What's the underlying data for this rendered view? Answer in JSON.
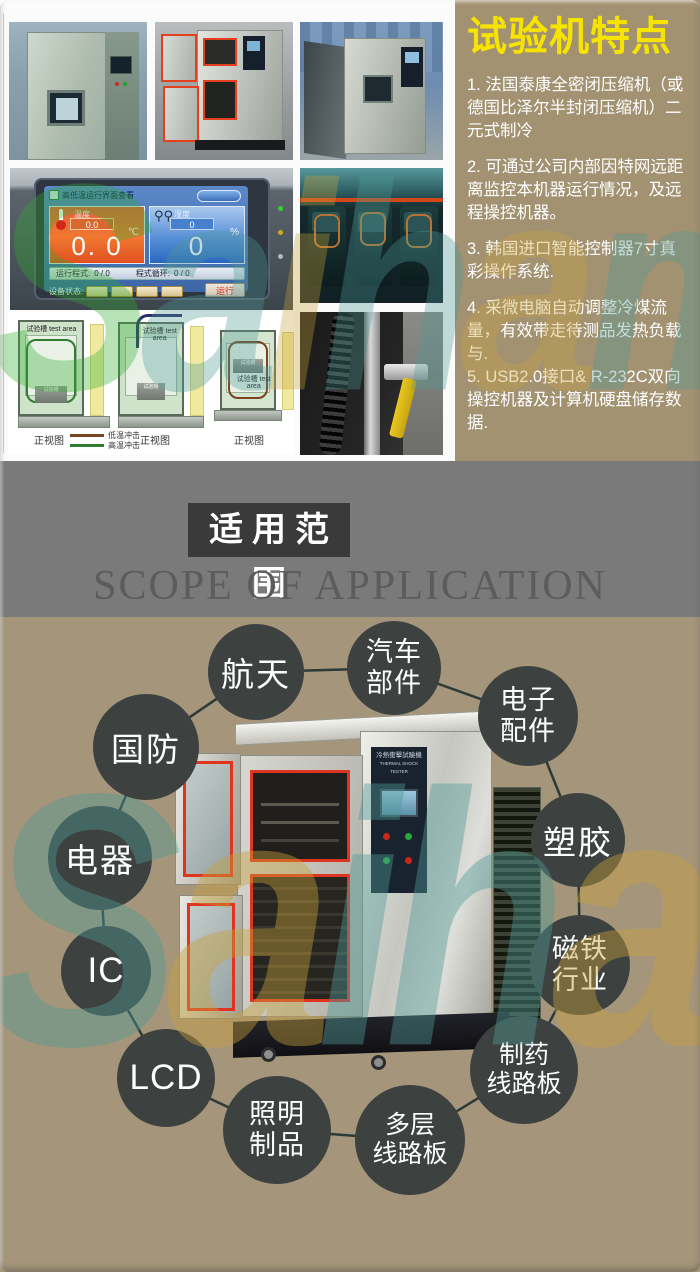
{
  "features": {
    "title": "试验机特点",
    "items": [
      "1. 法国泰康全密闭压缩机（或德国比泽尔半封闭压缩机）二元式制冷",
      "2. 可通过公司内部因特网远距离监控本机器运行情况，及远程操控机器。",
      "3. 韩国进口智能控制器7寸真彩操作系统.",
      "4. 采微电脑自动调整冷煤流量，有效带走待测品发热负载与.",
      "5. USB2.0接口& R-232C双向操控机器及计算机硬盘储存数据."
    ]
  },
  "controller": {
    "title": "高低温运行界面查看",
    "temp_label": "温度",
    "temp_value_small": "0.0",
    "temp_value": "0. 0",
    "temp_unit": "℃",
    "humidity_label": "湿度",
    "humidity_value_small": "0",
    "humidity_value": "0",
    "humidity_unit": "%",
    "program_label": "运行程式:",
    "program_value": "0 / 0",
    "cycle_label": "程式循环:",
    "cycle_value": "0 / 0",
    "status_label": "设备状态:",
    "run_label": "运行"
  },
  "diagram": {
    "chamber_label": "试验槽\ntest area",
    "tray_label": "试验槽",
    "view_label_1": "正视图",
    "view_label_2": "正视图",
    "view_label_3": "正视图",
    "legend": [
      {
        "label": "低温冲击",
        "color": "#7a4420"
      },
      {
        "label": "高温冲击",
        "color": "#2e7d32"
      }
    ]
  },
  "machine": {
    "plate_line1": "冷熱衝擊試驗機",
    "plate_line2": "THERMAL SHOCK TESTER"
  },
  "banner": {
    "title_cn": "适用范围",
    "title_en": "SCOPE OF APPLICATION"
  },
  "applications": {
    "items": [
      {
        "label": "航天"
      },
      {
        "label": "汽车\n部件"
      },
      {
        "label": "电子\n配件"
      },
      {
        "label": "塑胶"
      },
      {
        "label": "磁铁\n行业"
      },
      {
        "label": "制药\n线路板"
      },
      {
        "label": "多层\n线路板"
      },
      {
        "label": "照明\n制品"
      },
      {
        "label": "LCD"
      },
      {
        "label": "IC"
      },
      {
        "label": "电器"
      },
      {
        "label": "国防"
      }
    ]
  },
  "watermark": {
    "text": "Saiham"
  },
  "colors": {
    "panel_tan": "#a29272",
    "apps_tan": "#a5957b",
    "banner_gray": "#7a7a7a",
    "banner_box": "#3a3a3a",
    "title_yellow": "#f6e400",
    "circle_dark": "#3d4240",
    "gasket_red": "#df3420",
    "watermark_green": "#2fae2f",
    "watermark_teal": "#4f9a96",
    "watermark_yellow": "#c9a23b"
  }
}
